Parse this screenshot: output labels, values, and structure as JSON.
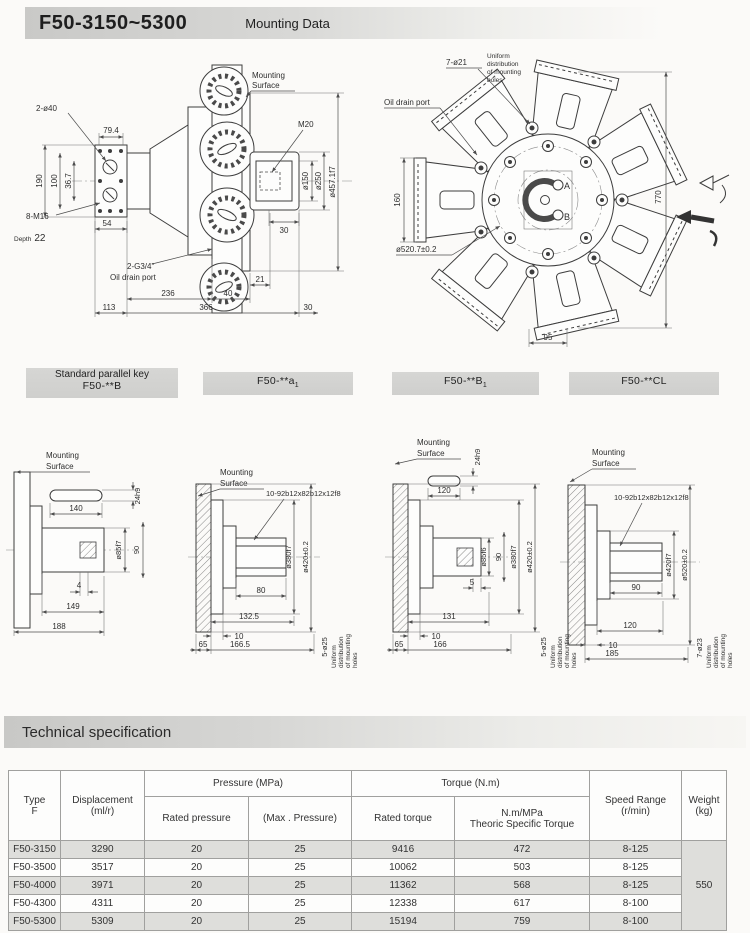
{
  "header": {
    "title": "F50-3150~5300",
    "subtitle": "Mounting Data"
  },
  "mounting_note": [
    "Mounting",
    "Surface"
  ],
  "uniform_note": [
    "Uniform",
    "distribution",
    "of mounting",
    "holes"
  ],
  "side_view": {
    "dims": {
      "ports": "2-ø40",
      "d79_4": "79.4",
      "d36_7": "36.7",
      "d100": "100",
      "d190": "190",
      "bolts": "8-M16",
      "depth_word": "Depth",
      "depth_val": "22",
      "d54": "54",
      "m20": "M20",
      "o150": "ø150",
      "o250": "ø250",
      "o457": "ø457.1f7",
      "d30_shaft": "30",
      "drain_ports": "2-G3/4\"",
      "drain_label": "Oil drain port",
      "d236": "236",
      "d40": "40",
      "d21": "21",
      "d113": "113",
      "d366": "366",
      "d30_end": "30"
    }
  },
  "front_view": {
    "dims": {
      "holes7": "7-ø21",
      "drain_label": "Oil drain port",
      "d160": "160",
      "d770": "770",
      "o520": "ø520.7±0.2",
      "d95": "95",
      "a": "A",
      "b": "B"
    }
  },
  "variants": [
    {
      "line1": "Standard parallel key",
      "line2": "F50-**B",
      "sub": ""
    },
    {
      "line1": "",
      "line2": "F50-**a",
      "sub": "1"
    },
    {
      "line1": "",
      "line2": "F50-**B",
      "sub": "1"
    },
    {
      "line1": "",
      "line2": "F50-**CL",
      "sub": ""
    }
  ],
  "d1": {
    "dims": {
      "key24": "24h9",
      "d140": "140",
      "o85": "ø85f7",
      "d90": "90",
      "d4": "4",
      "d149": "149",
      "d188": "188"
    }
  },
  "d2": {
    "dims": {
      "spline": "10-92b12x82b12x12f8",
      "d80": "80",
      "o380": "ø380f7",
      "o420": "ø420±0.2",
      "d132_5": "132.5",
      "d10": "10",
      "d65": "65",
      "d166_5": "166.5",
      "holes": "5-ø25"
    }
  },
  "d3": {
    "dims": {
      "key24": "24h9",
      "d120": "120",
      "o85": "ø85f6",
      "d90": "90",
      "o380": "ø380f7",
      "o420": "ø420±0.2",
      "d5": "5",
      "d131": "131",
      "d10": "10",
      "d65": "65",
      "d166": "166",
      "holes": "5-ø25"
    }
  },
  "d4": {
    "dims": {
      "spline": "10-92b12x82b12x12f8",
      "d90": "90",
      "o420": "ø420f7",
      "o520": "ø520±0.2",
      "d120": "120",
      "d10": "10",
      "d185": "185",
      "holes": "7-ø23"
    }
  },
  "spec": {
    "bar_title": "Technical specification",
    "table": {
      "col_type": [
        "Type",
        "F"
      ],
      "col_disp": [
        "Displacement",
        "(ml/r)"
      ],
      "grp_pressure": "Pressure (MPa)",
      "col_rated_p": "Rated pressure",
      "col_max_p": "(Max . Pressure)",
      "grp_torque": "Torque (N.m)",
      "col_rated_t": "Rated torque",
      "col_spec_t": [
        "N.m/MPa",
        "Theoric  Specific  Torque"
      ],
      "col_speed": [
        "Speed  Range",
        "(r/min)"
      ],
      "col_weight": [
        "Weight",
        "(kg)"
      ],
      "weight_value": "550",
      "rows": [
        [
          "F50-3150",
          "3290",
          "20",
          "25",
          "9416",
          "472",
          "8-125"
        ],
        [
          "F50-3500",
          "3517",
          "20",
          "25",
          "10062",
          "503",
          "8-125"
        ],
        [
          "F50-4000",
          "3971",
          "20",
          "25",
          "11362",
          "568",
          "8-125"
        ],
        [
          "F50-4300",
          "4311",
          "20",
          "25",
          "12338",
          "617",
          "8-100"
        ],
        [
          "F50-5300",
          "5309",
          "20",
          "25",
          "15194",
          "759",
          "8-100"
        ]
      ]
    }
  }
}
